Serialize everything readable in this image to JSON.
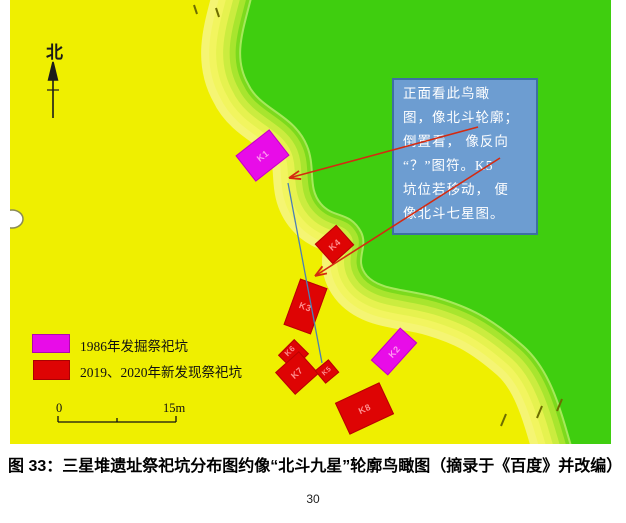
{
  "page": {
    "number": "30"
  },
  "caption": "图 33：三星堆遗址祭祀坑分布图约像“北斗九星”轮廓鸟瞰图（摘录于《百度》并改编）",
  "map": {
    "north_label": "北",
    "annotation_box": {
      "lines": [
        "正面看此鸟瞰",
        "图，像北斗轮廓；",
        "倒置看， 像反向",
        "“？”图符。K5",
        "坑位若移动， 便",
        "像北斗七星图。"
      ],
      "full_text": "正面看此鸟瞰图，像北斗轮廓；倒置看，像反向“？”图符。K5坑位若移动，便像北斗七星图。"
    },
    "pits": [
      {
        "label": "K1",
        "color": "#E80CE8"
      },
      {
        "label": "K2",
        "color": "#E80CE8"
      },
      {
        "label": "K3",
        "color": "#DE0404"
      },
      {
        "label": "K4",
        "color": "#DE0404"
      },
      {
        "label": "K5",
        "color": "#DE0404"
      },
      {
        "label": "K6",
        "color": "#DE0404"
      },
      {
        "label": "K7",
        "color": "#DE0404"
      },
      {
        "label": "K8",
        "color": "#DE0404"
      }
    ],
    "legend": {
      "items": [
        {
          "label": "1986年发掘祭祀坑",
          "color": "#E80CE8"
        },
        {
          "label": "2019、2020年新发现祭祀坑",
          "color": "#DE0404"
        }
      ]
    },
    "scale_bar": {
      "start": "0",
      "end": "15m"
    },
    "colors": {
      "lowland": "#EFEF00",
      "highland": "#3FCE0F",
      "annotation_fill": "#6D9DD1",
      "annotation_border": "#3D6FA3",
      "arrow": "#D42A10",
      "connector": "#4A7FB5"
    }
  }
}
